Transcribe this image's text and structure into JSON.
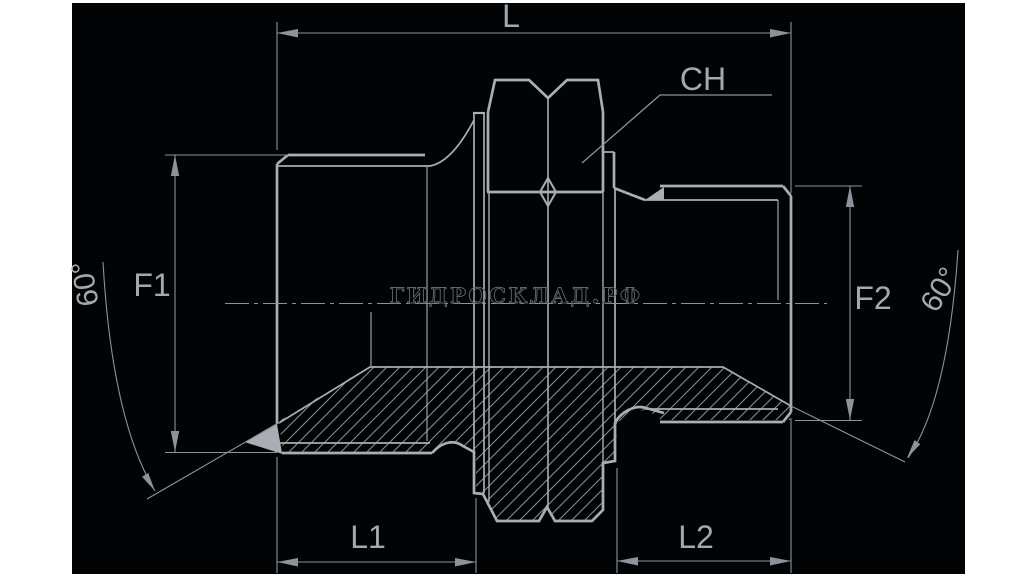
{
  "page": {
    "background_color": "#ffffff",
    "drawing_background_color": "#020304",
    "line_color": "#9aa0a6",
    "hatch_color": "#868c92",
    "watermark_color": "#62686e"
  },
  "drawing": {
    "type": "technical-drawing-hydraulic-adapter-section",
    "labels": {
      "overall_length": "L",
      "wrench_size": "CH",
      "thread_left": "F1",
      "thread_right": "F2",
      "length_left": "L1",
      "length_right": "L2",
      "cone_angle_left": "60°",
      "cone_angle_right": "60°"
    },
    "watermark": "ГИДРОСКЛАД.РФ"
  }
}
